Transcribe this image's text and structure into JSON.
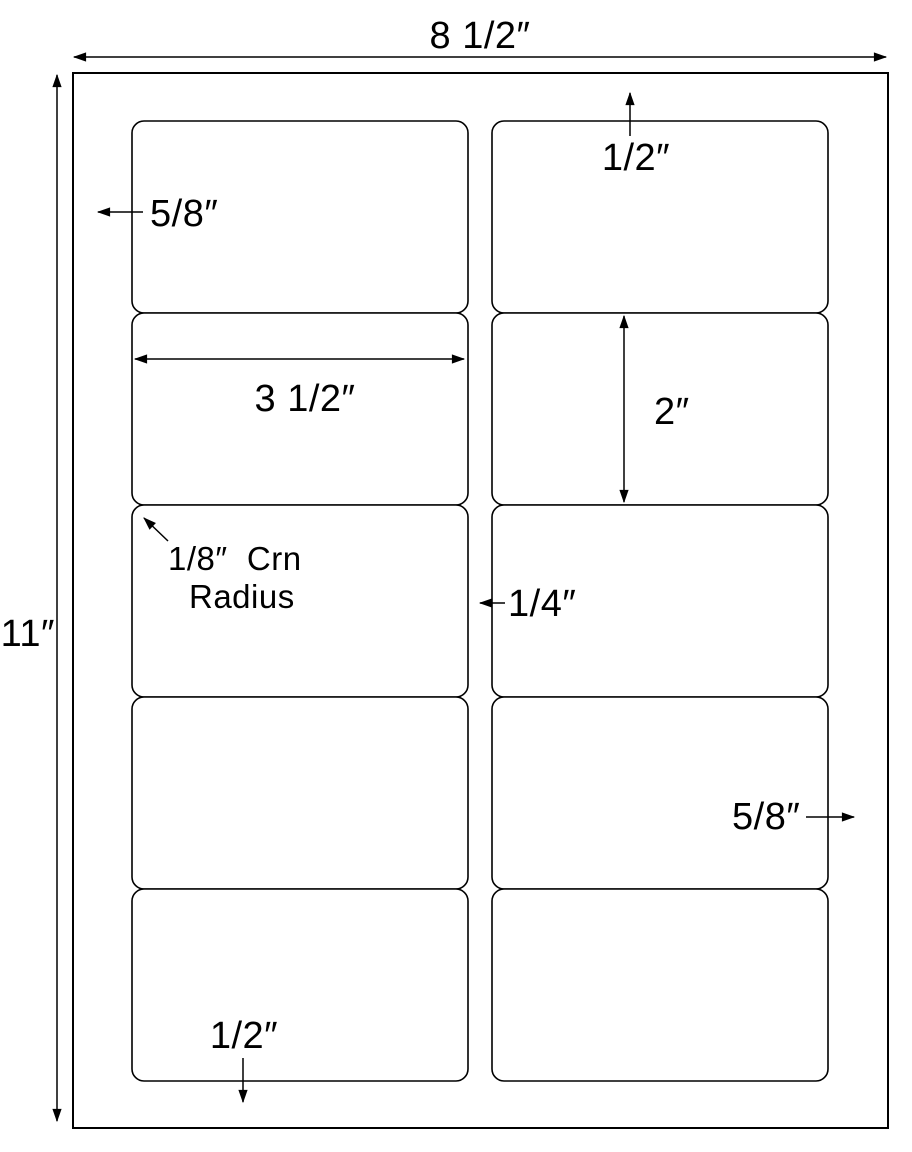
{
  "diagram": {
    "kind": "label-sheet-template",
    "grid": {
      "columns": 2,
      "rows": 5,
      "label_count": 10
    },
    "colors": {
      "line": "#000000",
      "background": "#ffffff"
    }
  },
  "sheet": {
    "width_label": "8 1/2″",
    "height_label": "11″"
  },
  "dimensions": {
    "top_margin": "1/2″",
    "bottom_margin": "1/2″",
    "left_margin": "5/8″",
    "right_margin": "5/8″",
    "column_gap": "1/4″",
    "label_width": "3 1/2″",
    "label_height": "2″",
    "corner_radius_line1": "1/8″  Crn",
    "corner_radius_line2": "Radius"
  }
}
